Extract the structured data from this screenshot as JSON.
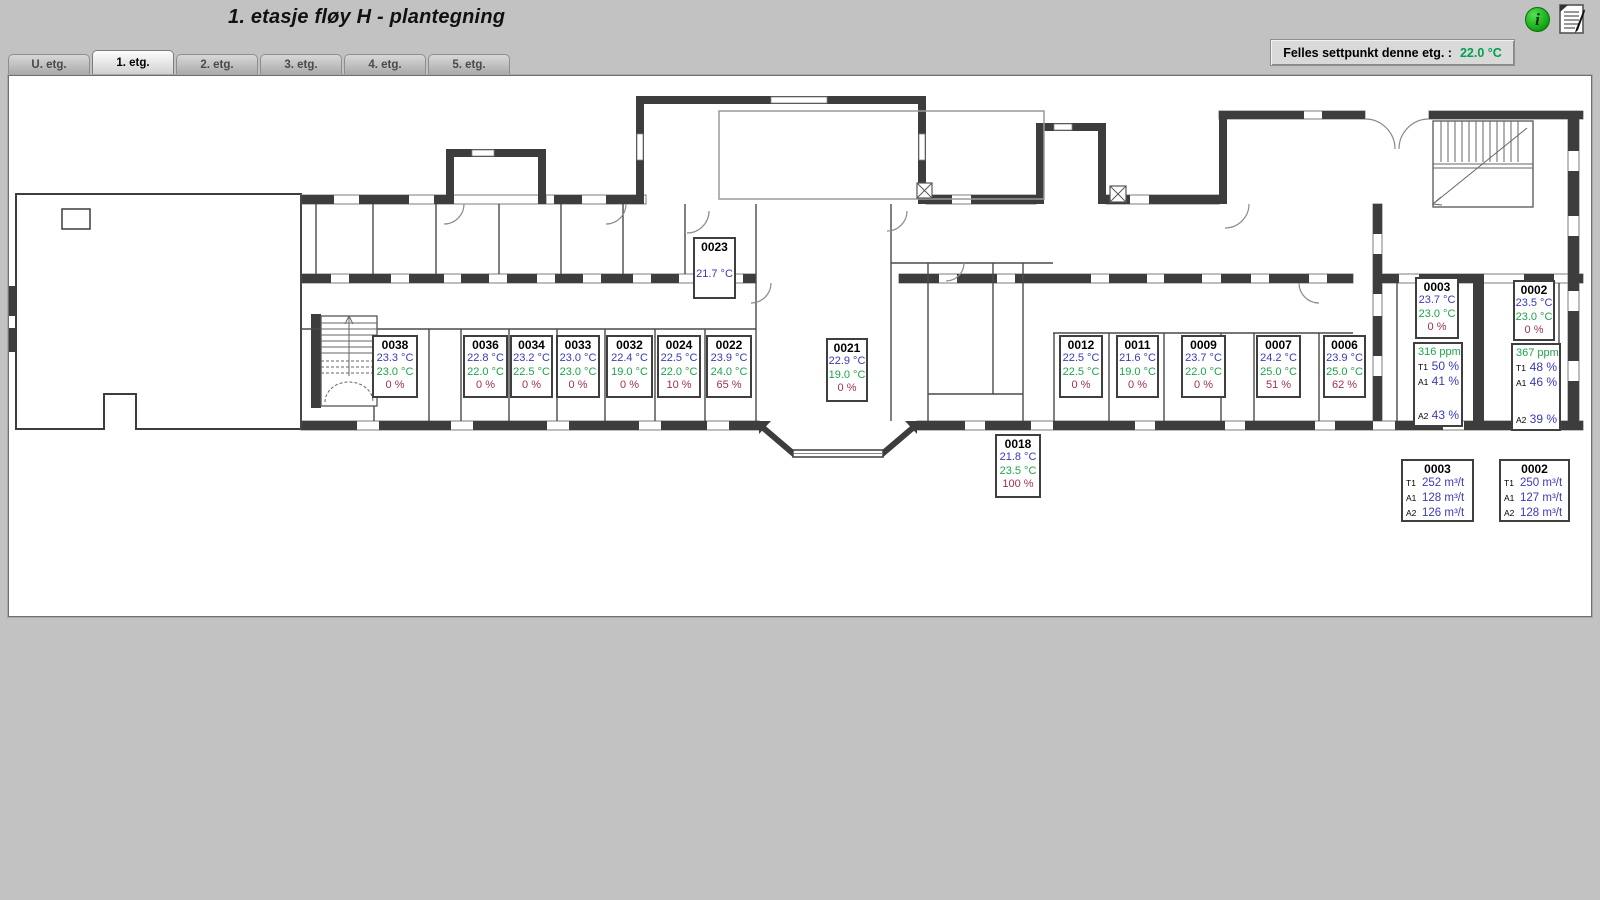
{
  "header": {
    "title": "1. etasje fløy H - plantegning"
  },
  "tabs": [
    {
      "label": "U. etg.",
      "active": false
    },
    {
      "label": "1. etg.",
      "active": true
    },
    {
      "label": "2. etg.",
      "active": false
    },
    {
      "label": "3. etg.",
      "active": false
    },
    {
      "label": "4. etg.",
      "active": false
    },
    {
      "label": "5. etg.",
      "active": false
    }
  ],
  "setpoint_bar": {
    "label": "Felles settpunkt denne etg. :",
    "value": "22.0 °C"
  },
  "icons": {
    "info_glyph": "i",
    "notepad": "notepad-icon"
  },
  "colors": {
    "measured_temp": "#3a3ab8",
    "setpoint_temp": "#1ea44c",
    "valve_percent": "#a03052",
    "co2_green": "#1ea44c",
    "background": "#c2c2c2",
    "wall_dark": "#3d3d3d"
  },
  "rooms": [
    {
      "id": "0038",
      "measured": "23.3 °C",
      "setpoint": "23.0 °C",
      "valve": "0 %"
    },
    {
      "id": "0036",
      "measured": "22.8 °C",
      "setpoint": "22.0 °C",
      "valve": "0 %"
    },
    {
      "id": "0034",
      "measured": "23.2 °C",
      "setpoint": "22.5 °C",
      "valve": "0 %"
    },
    {
      "id": "0033",
      "measured": "23.0 °C",
      "setpoint": "23.0 °C",
      "valve": "0 %"
    },
    {
      "id": "0032",
      "measured": "22.4 °C",
      "setpoint": "19.0 °C",
      "valve": "0 %"
    },
    {
      "id": "0024",
      "measured": "22.5 °C",
      "setpoint": "22.0 °C",
      "valve": "10 %"
    },
    {
      "id": "0022",
      "measured": "23.9 °C",
      "setpoint": "24.0 °C",
      "valve": "65 %"
    },
    {
      "id": "0023",
      "measured": "21.7 °C"
    },
    {
      "id": "0021",
      "measured": "22.9 °C",
      "setpoint": "19.0 °C",
      "valve": "0 %"
    },
    {
      "id": "0018",
      "measured": "21.8 °C",
      "setpoint": "23.5 °C",
      "valve": "100 %"
    },
    {
      "id": "0012",
      "measured": "22.5 °C",
      "setpoint": "22.5 °C",
      "valve": "0 %"
    },
    {
      "id": "0011",
      "measured": "21.6 °C",
      "setpoint": "19.0 °C",
      "valve": "0 %"
    },
    {
      "id": "0009",
      "measured": "23.7 °C",
      "setpoint": "22.0 °C",
      "valve": "0 %"
    },
    {
      "id": "0007",
      "measured": "24.2 °C",
      "setpoint": "25.0 °C",
      "valve": "51 %"
    },
    {
      "id": "0006",
      "measured": "23.9 °C",
      "setpoint": "25.0 °C",
      "valve": "62 %"
    },
    {
      "id": "0003",
      "measured": "23.7 °C",
      "setpoint": "23.0 °C",
      "valve": "0 %"
    },
    {
      "id": "0002",
      "measured": "23.5 °C",
      "setpoint": "23.0 °C",
      "valve": "0 %"
    }
  ],
  "vent_panels": [
    {
      "room": "0003",
      "co2": "316 ppm",
      "rows": [
        {
          "label": "T1",
          "value": "50 %"
        },
        {
          "label": "A1",
          "value": "41 %"
        },
        {
          "label": "A2",
          "value": "43 %"
        }
      ]
    },
    {
      "room": "0002",
      "co2": "367 ppm",
      "rows": [
        {
          "label": "T1",
          "value": "48 %"
        },
        {
          "label": "A1",
          "value": "46 %"
        },
        {
          "label": "A2",
          "value": "39 %"
        }
      ]
    }
  ],
  "flow_panels": [
    {
      "room": "0003",
      "rows": [
        {
          "label": "T1",
          "value": "252 m³/t"
        },
        {
          "label": "A1",
          "value": "128 m³/t"
        },
        {
          "label": "A2",
          "value": "126 m³/t"
        }
      ]
    },
    {
      "room": "0002",
      "rows": [
        {
          "label": "T1",
          "value": "250 m³/t"
        },
        {
          "label": "A1",
          "value": "127 m³/t"
        },
        {
          "label": "A2",
          "value": "128 m³/t"
        }
      ]
    }
  ]
}
